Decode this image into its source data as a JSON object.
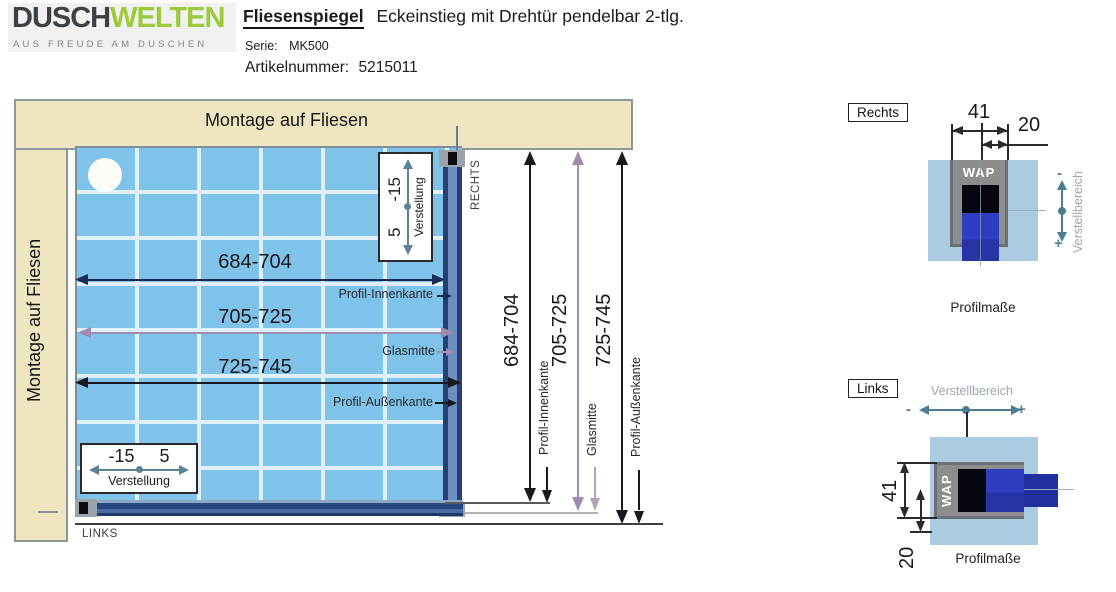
{
  "header": {
    "logo": {
      "part1": "DUSCH",
      "part2": "WELTEN",
      "tagline": "AUS FREUDE AM DUSCHEN"
    },
    "title": {
      "product": "Fliesenspiegel",
      "description": "Eckeinstieg mit Drehtür pendelbar 2-tlg."
    },
    "serie": {
      "label": "Serie:",
      "value": "MK500"
    },
    "artikel": {
      "label": "Artikelnummer:",
      "value": "5215011"
    }
  },
  "diagram": {
    "walls": {
      "top": "Montage auf Fliesen",
      "left": "Montage auf Fliesen"
    },
    "side_labels": {
      "rechts": "RECHTS",
      "links": "LINKS"
    },
    "dimensions": {
      "inner": {
        "value": "684-704",
        "label": "Profil-Innenkante"
      },
      "glass": {
        "value": "705-725",
        "label": "Glasmitte"
      },
      "outer": {
        "value": "725-745",
        "label": "Profil-Außenkante"
      }
    },
    "adjustment": {
      "neg": "-15",
      "pos": "5",
      "label": "Verstellung"
    }
  },
  "details": {
    "rechts": {
      "title": "Rechts",
      "dim_width": "41",
      "dim_glass": "20",
      "profile_label": "WAP",
      "range_label": "Verstellbereich",
      "minus": "-",
      "plus": "+",
      "caption": "Profilmaße"
    },
    "links": {
      "title": "Links",
      "dim_width": "41",
      "dim_glass": "20",
      "profile_label": "WAP",
      "range_label": "Verstellbereich",
      "minus": "-",
      "plus": "+",
      "caption": "Profilmaße"
    }
  },
  "colors": {
    "brand_green": "#9cca3b",
    "wall_beige": "#efe5c0",
    "tile_blue": "#80c3ea",
    "profile_navy": "#2a4a8c",
    "dim_purple": "#a08cae",
    "adjust_teal": "#4d7d92",
    "detail_tile_blue": "#abcbe1",
    "profile_gray": "#8d8d8d"
  }
}
